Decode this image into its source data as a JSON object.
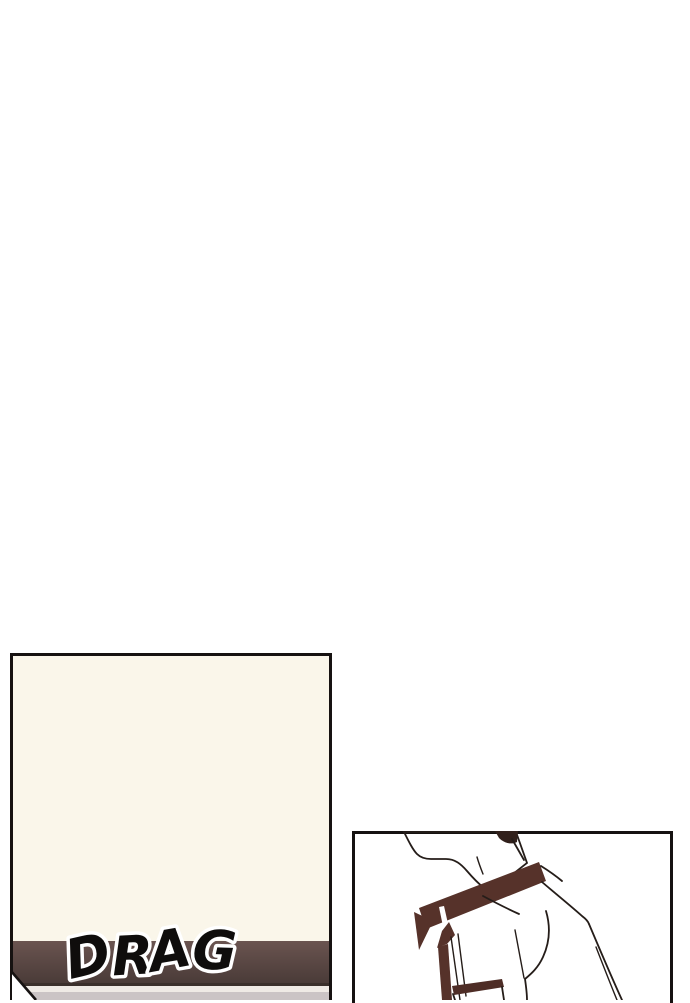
{
  "sfx": {
    "drag": "DRAG"
  },
  "palette": {
    "page_bg": "#FFFFFF",
    "panel_border": "#161211",
    "panel_left_bg": "#FAF6EA",
    "speed_bar_top": "#6A5450",
    "speed_bar_bottom": "#4A3B38",
    "bar_edge": "#3A2F2B",
    "gap_band": "#EFEAE5",
    "grey_band": "#CBC4C5",
    "skin": "#F5ECDA",
    "hair": "#31201B",
    "collar": "#56322A",
    "pocket": "#4E2D26",
    "line": "#251D19",
    "sfx_fill": "#0F0D0C",
    "sfx_outline": "#FFFFFF"
  }
}
